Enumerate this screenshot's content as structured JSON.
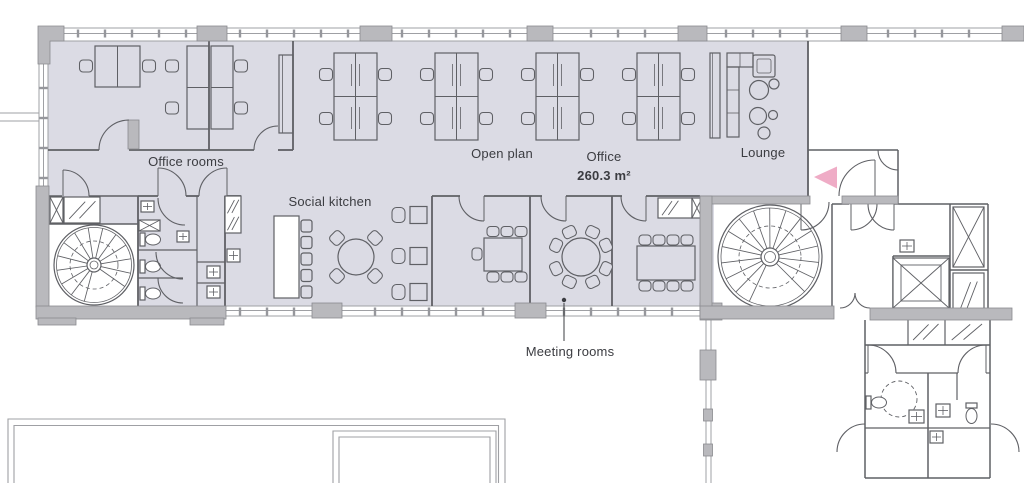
{
  "title": "Office floor plan",
  "labels": [
    {
      "id": "office_rooms",
      "text": "Office rooms",
      "x": 186,
      "y": 166,
      "bold": false
    },
    {
      "id": "open_plan",
      "text": "Open plan",
      "x": 502,
      "y": 158,
      "bold": false
    },
    {
      "id": "office",
      "text": "Office",
      "x": 604,
      "y": 161,
      "bold": false
    },
    {
      "id": "office_area",
      "text": "260.3 m²",
      "x": 604,
      "y": 180,
      "bold": true
    },
    {
      "id": "lounge",
      "text": "Lounge",
      "x": 763,
      "y": 157,
      "bold": false
    },
    {
      "id": "social_kitchen",
      "text": "Social kitchen",
      "x": 330,
      "y": 206,
      "bold": false
    },
    {
      "id": "meeting_rooms",
      "text": "Meeting rooms",
      "x": 570,
      "y": 356,
      "bold": false
    }
  ],
  "annotations": {
    "meeting_rooms_leader": {
      "dot_x": 564,
      "dot_y": 300,
      "line_to_y": 341
    }
  },
  "icons": {
    "entrance_arrow": "left-pointing-triangle"
  },
  "colors": {
    "floor": "#dbdbe4",
    "wall": "#b9b9bd",
    "wall_stroke": "#8a8b8f",
    "line": "#5f6065",
    "light_line": "#9fa0a4",
    "tick": "#96979c",
    "pink": "#efacc6",
    "text": "#3b3c41",
    "white": "#ffffff"
  }
}
